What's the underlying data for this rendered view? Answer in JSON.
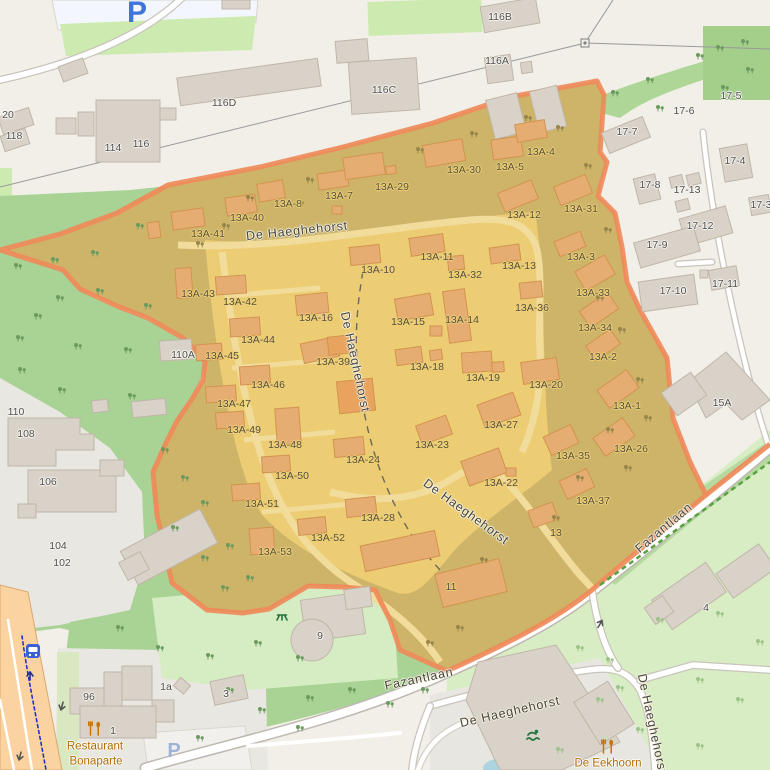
{
  "map": {
    "colors": {
      "highlight_border": "#ef8a5a",
      "highlight_fill_olive": "#cdb469",
      "highlight_fill_bright": "#eccd74",
      "forest_green": "#a9d295",
      "grass_green": "#cdeab0",
      "pale_green": "#d8edc4",
      "water_blue": "#abd4e0",
      "road_primary": "#fbd3a0",
      "poi_text": "#b06a00",
      "parking_blue": "#3f74d9",
      "cycleway_blue": "#2433c8"
    },
    "labels": [
      {
        "t": "De Haeghehorst",
        "x": 297,
        "y": 231,
        "rot": -6,
        "c": "street",
        "n": "street-name-label"
      },
      {
        "t": "De Haeghehorst",
        "x": 355,
        "y": 362,
        "rot": 78,
        "c": "street",
        "n": "street-name-label"
      },
      {
        "t": "De Haeghehorst",
        "x": 466,
        "y": 512,
        "rot": 36,
        "c": "street",
        "n": "street-name-label"
      },
      {
        "t": "De Haeghehorst",
        "x": 510,
        "y": 712,
        "rot": -13,
        "c": "street",
        "n": "street-name-label"
      },
      {
        "t": "De Haeghehorst",
        "x": 652,
        "y": 724,
        "rot": 78,
        "c": "street",
        "n": "street-name-label"
      },
      {
        "t": "Fazantlaan",
        "x": 419,
        "y": 679,
        "rot": -12,
        "c": "street",
        "n": "street-name-label"
      },
      {
        "t": "Fazantlaan",
        "x": 664,
        "y": 528,
        "rot": -40,
        "c": "street",
        "n": "street-name-label"
      },
      {
        "t": "116B",
        "x": 500,
        "y": 17,
        "c": "h-out"
      },
      {
        "t": "116A",
        "x": 497,
        "y": 61,
        "c": "h-out"
      },
      {
        "t": "116C",
        "x": 384,
        "y": 90,
        "c": "h-out"
      },
      {
        "t": "116D",
        "x": 224,
        "y": 103,
        "c": "h-out"
      },
      {
        "t": "116",
        "x": 141,
        "y": 144,
        "c": "h-out"
      },
      {
        "t": "114",
        "x": 113,
        "y": 148,
        "c": "h-out"
      },
      {
        "t": "20",
        "x": 8,
        "y": 115,
        "c": "h-out"
      },
      {
        "t": "118",
        "x": 14,
        "y": 136,
        "c": "h-out"
      },
      {
        "t": "17-5",
        "x": 731,
        "y": 96,
        "c": "h-out"
      },
      {
        "t": "17-6",
        "x": 684,
        "y": 111,
        "c": "h-out"
      },
      {
        "t": "17-7",
        "x": 627,
        "y": 132,
        "c": "h-out"
      },
      {
        "t": "17-4",
        "x": 735,
        "y": 161,
        "c": "h-out"
      },
      {
        "t": "17-8",
        "x": 650,
        "y": 185,
        "c": "h-out"
      },
      {
        "t": "17-13",
        "x": 687,
        "y": 190,
        "c": "h-out"
      },
      {
        "t": "17-3",
        "x": 761,
        "y": 205,
        "c": "h-out"
      },
      {
        "t": "17-12",
        "x": 700,
        "y": 226,
        "c": "h-out"
      },
      {
        "t": "17-9",
        "x": 657,
        "y": 245,
        "c": "h-out"
      },
      {
        "t": "17-10",
        "x": 673,
        "y": 291,
        "c": "h-out"
      },
      {
        "t": "17-11",
        "x": 725,
        "y": 284,
        "c": "h-out"
      },
      {
        "t": "110A",
        "x": 183,
        "y": 355,
        "c": "h-out"
      },
      {
        "t": "110",
        "x": 16,
        "y": 412,
        "c": "h-out"
      },
      {
        "t": "108",
        "x": 26,
        "y": 434,
        "c": "h-out"
      },
      {
        "t": "106",
        "x": 48,
        "y": 482,
        "c": "h-out"
      },
      {
        "t": "104",
        "x": 58,
        "y": 546,
        "c": "h-out"
      },
      {
        "t": "102",
        "x": 62,
        "y": 563,
        "c": "h-out"
      },
      {
        "t": "96",
        "x": 89,
        "y": 697,
        "c": "h-out"
      },
      {
        "t": "1a",
        "x": 166,
        "y": 687,
        "c": "h-out"
      },
      {
        "t": "3",
        "x": 226,
        "y": 694,
        "c": "h-out"
      },
      {
        "t": "1",
        "x": 113,
        "y": 731,
        "c": "h-out"
      },
      {
        "t": "15A",
        "x": 722,
        "y": 403,
        "c": "h-out"
      },
      {
        "t": "4",
        "x": 706,
        "y": 608,
        "c": "h-out"
      },
      {
        "t": "9",
        "x": 320,
        "y": 636,
        "c": "h-out"
      },
      {
        "t": "13A-8",
        "x": 288,
        "y": 204,
        "c": "h-in"
      },
      {
        "t": "13A-7",
        "x": 339,
        "y": 196,
        "c": "h-in"
      },
      {
        "t": "13A-29",
        "x": 392,
        "y": 187,
        "c": "h-in"
      },
      {
        "t": "13A-30",
        "x": 464,
        "y": 170,
        "c": "h-in"
      },
      {
        "t": "13A-5",
        "x": 510,
        "y": 167,
        "c": "h-in"
      },
      {
        "t": "13A-4",
        "x": 541,
        "y": 152,
        "c": "h-in"
      },
      {
        "t": "13A-40",
        "x": 247,
        "y": 218,
        "c": "h-in"
      },
      {
        "t": "13A-41",
        "x": 208,
        "y": 234,
        "c": "h-in"
      },
      {
        "t": "13A-12",
        "x": 524,
        "y": 215,
        "c": "h-in"
      },
      {
        "t": "13A-31",
        "x": 581,
        "y": 209,
        "c": "h-in"
      },
      {
        "t": "13A-3",
        "x": 581,
        "y": 257,
        "c": "h-in"
      },
      {
        "t": "13A-10",
        "x": 378,
        "y": 270,
        "c": "h-in"
      },
      {
        "t": "13A-11",
        "x": 437,
        "y": 257,
        "c": "h-in"
      },
      {
        "t": "13A-32",
        "x": 465,
        "y": 275,
        "c": "h-in"
      },
      {
        "t": "13A-13",
        "x": 519,
        "y": 266,
        "c": "h-in"
      },
      {
        "t": "13A-43",
        "x": 198,
        "y": 294,
        "c": "h-in"
      },
      {
        "t": "13A-42",
        "x": 240,
        "y": 302,
        "c": "h-in"
      },
      {
        "t": "13A-16",
        "x": 316,
        "y": 318,
        "c": "h-in"
      },
      {
        "t": "13A-15",
        "x": 408,
        "y": 322,
        "c": "h-in"
      },
      {
        "t": "13A-14",
        "x": 462,
        "y": 320,
        "c": "h-in"
      },
      {
        "t": "13A-36",
        "x": 532,
        "y": 308,
        "c": "h-in"
      },
      {
        "t": "13A-33",
        "x": 593,
        "y": 293,
        "c": "h-in"
      },
      {
        "t": "13A-44",
        "x": 258,
        "y": 340,
        "c": "h-in"
      },
      {
        "t": "13A-45",
        "x": 222,
        "y": 356,
        "c": "h-in"
      },
      {
        "t": "13A-39",
        "x": 333,
        "y": 362,
        "c": "h-in"
      },
      {
        "t": "13A-34",
        "x": 595,
        "y": 328,
        "c": "h-in"
      },
      {
        "t": "13A-2",
        "x": 603,
        "y": 357,
        "c": "h-in"
      },
      {
        "t": "13A-18",
        "x": 427,
        "y": 367,
        "c": "h-in"
      },
      {
        "t": "13A-19",
        "x": 483,
        "y": 378,
        "c": "h-in"
      },
      {
        "t": "13A-20",
        "x": 546,
        "y": 385,
        "c": "h-in"
      },
      {
        "t": "13A-46",
        "x": 268,
        "y": 385,
        "c": "h-in"
      },
      {
        "t": "13A-47",
        "x": 234,
        "y": 404,
        "c": "h-in"
      },
      {
        "t": "13A-1",
        "x": 627,
        "y": 406,
        "c": "h-in"
      },
      {
        "t": "13A-49",
        "x": 244,
        "y": 430,
        "c": "h-in"
      },
      {
        "t": "13A-48",
        "x": 285,
        "y": 445,
        "c": "h-in"
      },
      {
        "t": "13A-27",
        "x": 501,
        "y": 425,
        "c": "h-in"
      },
      {
        "t": "13A-23",
        "x": 432,
        "y": 445,
        "c": "h-in"
      },
      {
        "t": "13A-35",
        "x": 573,
        "y": 456,
        "c": "h-in"
      },
      {
        "t": "13A-26",
        "x": 631,
        "y": 449,
        "c": "h-in"
      },
      {
        "t": "13A-24",
        "x": 363,
        "y": 460,
        "c": "h-in"
      },
      {
        "t": "13A-22",
        "x": 501,
        "y": 483,
        "c": "h-in"
      },
      {
        "t": "13A-50",
        "x": 292,
        "y": 476,
        "c": "h-in"
      },
      {
        "t": "13A-37",
        "x": 593,
        "y": 501,
        "c": "h-in"
      },
      {
        "t": "13A-51",
        "x": 262,
        "y": 504,
        "c": "h-in"
      },
      {
        "t": "13A-28",
        "x": 378,
        "y": 518,
        "c": "h-in"
      },
      {
        "t": "13A-52",
        "x": 328,
        "y": 538,
        "c": "h-in"
      },
      {
        "t": "13A-53",
        "x": 275,
        "y": 552,
        "c": "h-in"
      },
      {
        "t": "13",
        "x": 556,
        "y": 533,
        "c": "h-in"
      },
      {
        "t": "11",
        "x": 451,
        "y": 587,
        "c": "h-in"
      },
      {
        "t": "Restaurant",
        "x": 95,
        "y": 747,
        "c": "poi",
        "n": "poi-label-restaurant-bonaparte"
      },
      {
        "t": "Bonaparte",
        "x": 96,
        "y": 762,
        "c": "poi",
        "n": "poi-label-restaurant-bonaparte"
      },
      {
        "t": "De Eekhoorn",
        "x": 608,
        "y": 764,
        "c": "poi",
        "n": "poi-label-de-eekhoorn"
      },
      {
        "t": "P",
        "x": 137,
        "y": 13,
        "c": "p-big",
        "n": "parking-icon"
      },
      {
        "t": "P",
        "x": 174,
        "y": 751,
        "c": "p-small",
        "n": "parking-icon"
      }
    ],
    "symbols": {
      "trees": [
        [
          18,
          268,
          "t-f"
        ],
        [
          55,
          262,
          "t-f"
        ],
        [
          140,
          228,
          "t-f"
        ],
        [
          100,
          293,
          "t-f"
        ],
        [
          38,
          318,
          "t-f"
        ],
        [
          148,
          308,
          "t-f"
        ],
        [
          78,
          348,
          "t-f"
        ],
        [
          128,
          352,
          "t-f"
        ],
        [
          22,
          372,
          "t-f"
        ],
        [
          62,
          392,
          "t-f"
        ],
        [
          132,
          398,
          "t-f"
        ],
        [
          20,
          340,
          "t-f"
        ],
        [
          95,
          255,
          "t-f"
        ],
        [
          60,
          300,
          "t-f"
        ],
        [
          165,
          452,
          "t-f"
        ],
        [
          185,
          480,
          "t-f"
        ],
        [
          205,
          505,
          "t-f"
        ],
        [
          175,
          530,
          "t-f"
        ],
        [
          205,
          560,
          "t-f"
        ],
        [
          230,
          548,
          "t-f"
        ],
        [
          250,
          580,
          "t-f"
        ],
        [
          225,
          590,
          "t-f"
        ],
        [
          120,
          630,
          "t-f"
        ],
        [
          160,
          650,
          "t-f"
        ],
        [
          210,
          658,
          "t-f"
        ],
        [
          258,
          645,
          "t-f"
        ],
        [
          300,
          660,
          "t-f"
        ],
        [
          230,
          692,
          "t-f"
        ],
        [
          262,
          712,
          "t-f"
        ],
        [
          310,
          700,
          "t-f"
        ],
        [
          352,
          692,
          "t-f"
        ],
        [
          390,
          706,
          "t-f"
        ],
        [
          425,
          692,
          "t-f"
        ],
        [
          300,
          730,
          "t-f"
        ],
        [
          200,
          740,
          "t-f"
        ],
        [
          580,
          650,
          "t-p"
        ],
        [
          610,
          662,
          "t-p"
        ],
        [
          700,
          682,
          "t-p"
        ],
        [
          740,
          702,
          "t-p"
        ],
        [
          660,
          622,
          "t-p"
        ],
        [
          720,
          616,
          "t-p"
        ],
        [
          760,
          644,
          "t-p"
        ],
        [
          600,
          702,
          "t-p"
        ],
        [
          640,
          732,
          "t-p"
        ],
        [
          700,
          748,
          "t-p"
        ],
        [
          560,
          752,
          "t-p"
        ],
        [
          620,
          690,
          "t-p"
        ],
        [
          615,
          95,
          "t-f"
        ],
        [
          650,
          82,
          "t-f"
        ],
        [
          700,
          58,
          "t-f"
        ],
        [
          745,
          44,
          "t-f"
        ],
        [
          725,
          90,
          "t-f"
        ],
        [
          660,
          110,
          "t-f"
        ],
        [
          720,
          50,
          "t-f"
        ],
        [
          750,
          72,
          "t-f"
        ],
        [
          560,
          130,
          "t-o"
        ],
        [
          588,
          168,
          "t-o"
        ],
        [
          608,
          232,
          "t-o"
        ],
        [
          600,
          300,
          "t-o"
        ],
        [
          622,
          332,
          "t-o"
        ],
        [
          640,
          382,
          "t-o"
        ],
        [
          648,
          420,
          "t-o"
        ],
        [
          610,
          432,
          "t-o"
        ],
        [
          580,
          480,
          "t-o"
        ],
        [
          628,
          470,
          "t-o"
        ],
        [
          556,
          520,
          "t-o"
        ],
        [
          484,
          562,
          "t-o"
        ],
        [
          250,
          200,
          "t-o"
        ],
        [
          310,
          182,
          "t-o"
        ],
        [
          420,
          152,
          "t-o"
        ],
        [
          474,
          136,
          "t-o"
        ],
        [
          528,
          120,
          "t-o"
        ],
        [
          200,
          246,
          "t-o"
        ],
        [
          226,
          228,
          "t-o"
        ],
        [
          300,
          205,
          "t-o"
        ],
        [
          430,
          645,
          "t-o"
        ],
        [
          460,
          630,
          "t-o"
        ]
      ],
      "arrows": [
        [
          62,
          706,
          195,
          "a-dark"
        ],
        [
          20,
          756,
          195,
          "a-dark"
        ],
        [
          600,
          624,
          30,
          "a-dark"
        ],
        [
          30,
          676,
          0,
          "a-navy"
        ]
      ]
    }
  }
}
